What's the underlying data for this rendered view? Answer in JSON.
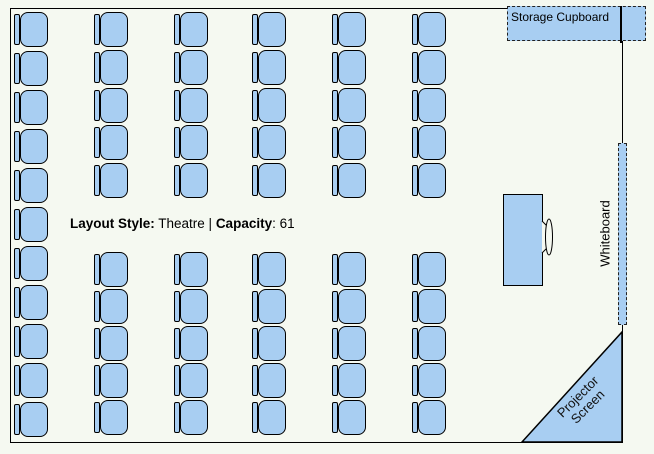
{
  "colors": {
    "background": "#f5f9f1",
    "object_fill": "#a8cef2",
    "object_stroke": "#000000"
  },
  "info": {
    "layout_style_label": "Layout Style:",
    "layout_style_value": " Theatre | ",
    "capacity_label": "Capacity",
    "capacity_suffix": ": 61",
    "layout_style": "Theatre",
    "capacity": 61
  },
  "fixtures": {
    "storage_cupboard": {
      "label": "Storage Cupboard"
    },
    "whiteboard": {
      "label": "Whiteboard"
    },
    "projector_screen": {
      "line1": "Projector",
      "line2": "Screen"
    }
  },
  "seating": {
    "chair_width": 34,
    "chair_height": 35,
    "total_chairs": 61,
    "columns": [
      {
        "x": 14,
        "rows": [
          12,
          51,
          90,
          129,
          168,
          207,
          246,
          285,
          324,
          363,
          402
        ]
      },
      {
        "x": 94,
        "rows": [
          12,
          50,
          88,
          125,
          163,
          252,
          289,
          326,
          363,
          400
        ]
      },
      {
        "x": 174,
        "rows": [
          12,
          50,
          88,
          125,
          163,
          252,
          289,
          326,
          363,
          400
        ]
      },
      {
        "x": 252,
        "rows": [
          12,
          50,
          88,
          125,
          163,
          252,
          289,
          326,
          363,
          400
        ]
      },
      {
        "x": 332,
        "rows": [
          12,
          50,
          88,
          125,
          163,
          252,
          289,
          326,
          363,
          400
        ]
      },
      {
        "x": 412,
        "rows": [
          12,
          50,
          88,
          125,
          163,
          252,
          289,
          326,
          363,
          400
        ]
      }
    ]
  }
}
